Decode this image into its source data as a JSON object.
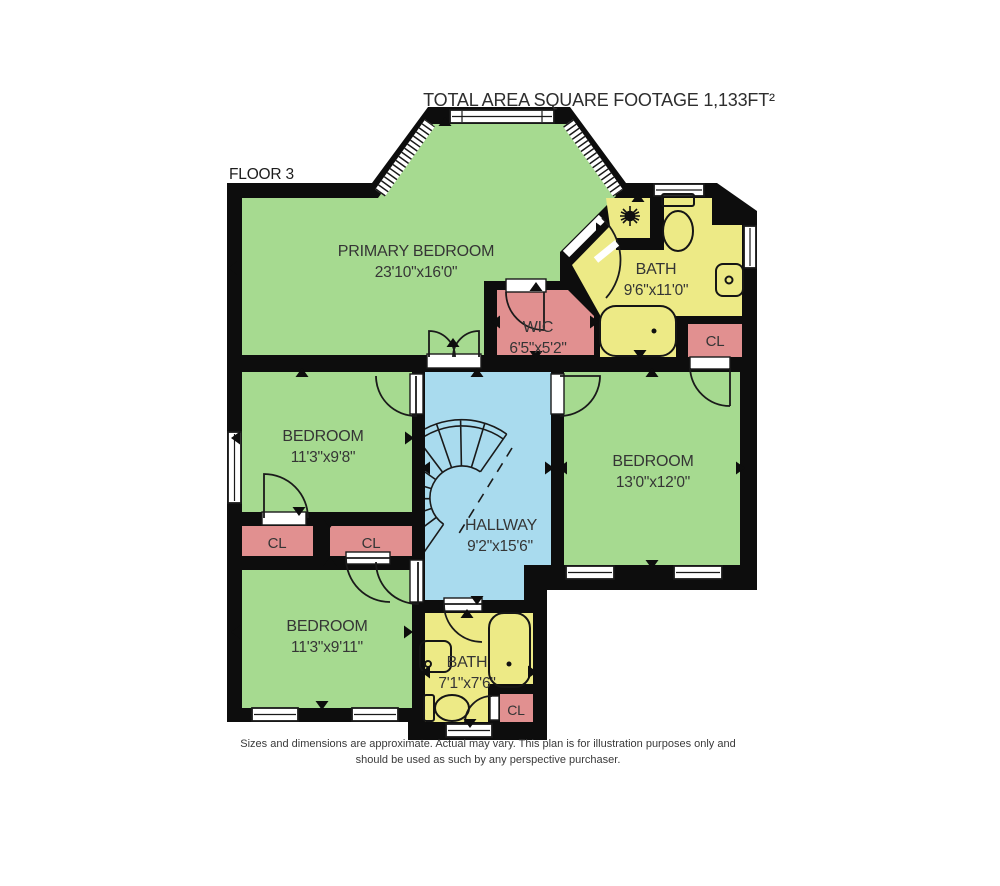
{
  "title": "TOTAL AREA SQUARE FOOTAGE 1,133FT²",
  "floor_label": "FLOOR 3",
  "rooms": {
    "primary_bedroom": {
      "name": "PRIMARY BEDROOM",
      "dims": "23'10\"x16'0\""
    },
    "bath_upper": {
      "name": "BATH",
      "dims": "9'6\"x11'0\""
    },
    "wic": {
      "name": "WIC",
      "dims": "6'5\"x5'2\""
    },
    "closet_upper_right": {
      "name": "CL"
    },
    "bedroom_mid_left": {
      "name": "BEDROOM",
      "dims": "11'3\"x9'8\""
    },
    "bedroom_right": {
      "name": "BEDROOM",
      "dims": "13'0\"x12'0\""
    },
    "hallway": {
      "name": "HALLWAY",
      "dims": "9'2\"x15'6\""
    },
    "closet_left": {
      "name": "CL"
    },
    "closet_mid": {
      "name": "CL"
    },
    "bedroom_lower_left": {
      "name": "BEDROOM",
      "dims": "11'3\"x9'11\""
    },
    "bath_lower": {
      "name": "BATH",
      "dims": "7'1\"x7'6\""
    },
    "closet_lower": {
      "name": "CL"
    }
  },
  "disclaimer": {
    "line1": "Sizes and dimensions are approximate. Actual may vary. This plan is for illustration purposes only and",
    "line2": "should be used as such by any perspective purchaser."
  },
  "colors": {
    "bedroom": "#a6da90",
    "bath": "#edea86",
    "hallway": "#a9dbee",
    "closet": "#e19090",
    "wall": "#0d0d0d"
  }
}
